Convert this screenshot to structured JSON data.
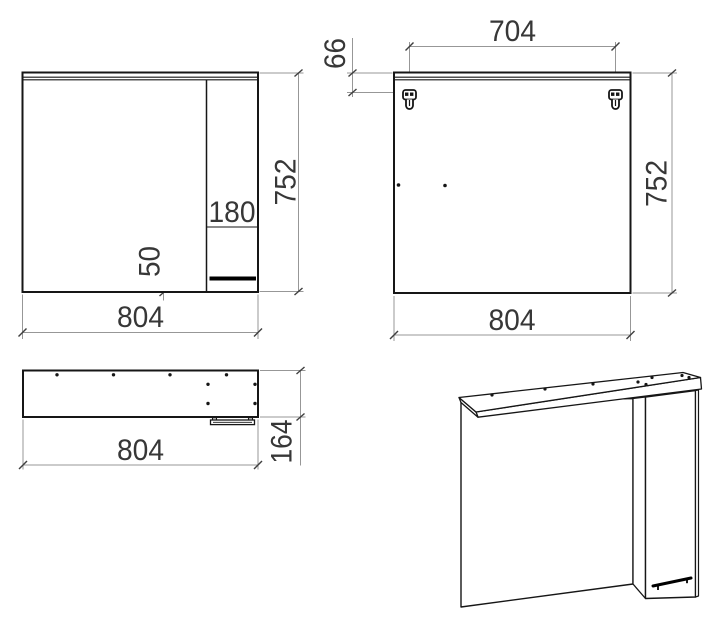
{
  "front_view": {
    "width_label": "804",
    "height_label": "752",
    "door_width_label": "180",
    "handle_bottom_offset_label": "50"
  },
  "back_view": {
    "hanger_spacing_label": "704",
    "hanger_top_offset_label": "66",
    "height_label": "752",
    "width_label": "804"
  },
  "top_view": {
    "width_label": "804",
    "depth_label": "164"
  },
  "colors": {
    "object_line": "#161616",
    "dimension_line": "#979797",
    "text": "#373737",
    "background": "#ffffff"
  }
}
